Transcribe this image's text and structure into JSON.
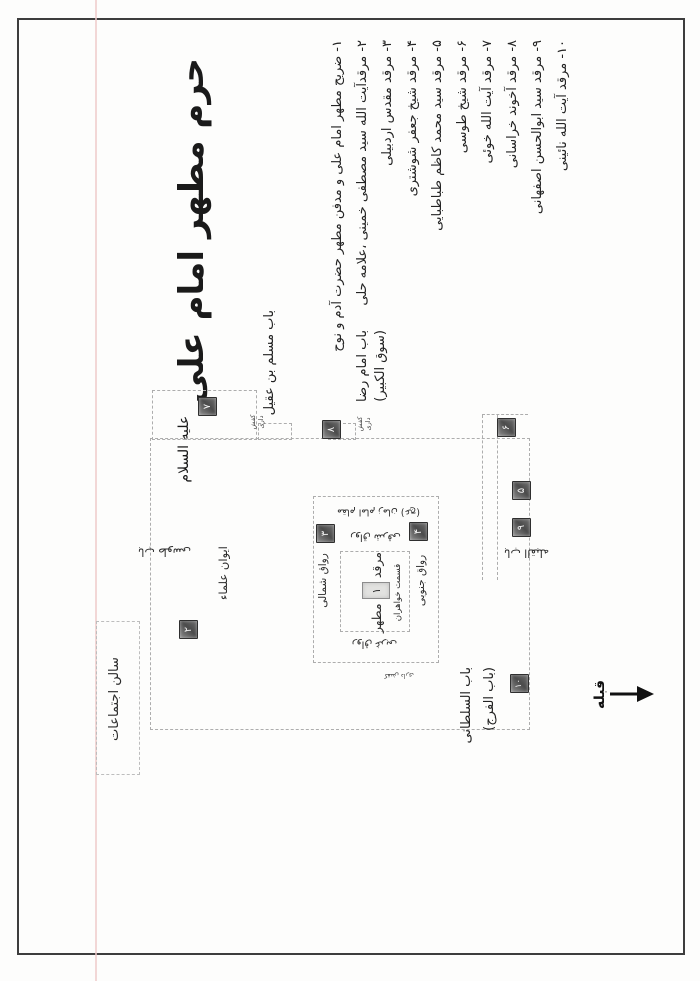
{
  "title": {
    "main": "حرم مطهر امام علی",
    "honorific": "علیه السلام"
  },
  "legend": {
    "items": [
      "۱- ضریح مطهر امام علی و مدفن مطهر حضرت آدم و نوح",
      "۲- مرقدآیت الله سید مصطفی خمینی ،علامه حلی",
      "۳- مرقد مقدس اردبیلی",
      "۴- مرقد شیخ جعفر شوشتری",
      "۵- مرقد سید محمد کاظم طباطبایی",
      "۶- مرقد شیخ طوسی",
      "۷- مرقد آیت الله خوئی",
      "۸- مرقد آخوند خراسانی",
      "۹- مرقد سید ابوالحسن اصفهانی",
      "۱۰- مرقد آیت الله نائینی"
    ]
  },
  "map": {
    "gates": {
      "muslim": "باب مسلم بن عقیل",
      "reza_line1": "باب امام رضا",
      "reza_line2": "(سوق الکبیر)",
      "tusi": "باب طوسی",
      "qibla": "باب القبله",
      "sultani_line1": "باب السلطانی",
      "sultani_line2": "(باب الفرج)"
    },
    "areas": {
      "iwan_ulama": "ایوان علماء",
      "assembly_hall": "سالن اجتماعات",
      "ravaq_north": "رواق شمالی",
      "ravaq_south": "رواق جنوبی",
      "ravaq_east": "رواق شرقی",
      "ravaq_west": "رواق غربی",
      "tomb_word1": "مرقد",
      "tomb_word2": "مطهر",
      "women_section": "قسمت خواهران",
      "maqam": "مقام امام زمان (عج)",
      "shoe_line1": "کفش",
      "shoe_line2": "داری"
    },
    "qibla_label": "قبله",
    "markers": {
      "m1": "۱",
      "m2": "۲",
      "m3": "۳",
      "m4": "۴",
      "m5": "۵",
      "m6": "۶",
      "m7": "۷",
      "m8": "۸",
      "m9": "۹",
      "m10": "۱۰"
    }
  }
}
